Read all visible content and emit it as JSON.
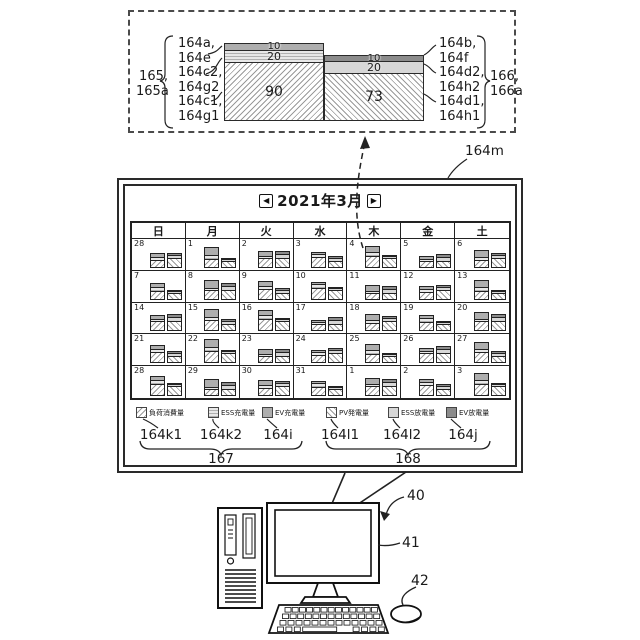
{
  "detail_inset": {
    "left_group_label": {
      "l1": "165,",
      "l2": "165a"
    },
    "right_group_label": {
      "l1": "166,",
      "l2": "166a"
    },
    "left_refs": [
      {
        "l1": "164a,",
        "l2": "164e"
      },
      {
        "l1": "164c2,",
        "l2": "164g2"
      },
      {
        "l1": "164c1,",
        "l2": "164g1"
      }
    ],
    "right_refs": [
      {
        "l1": "164b,",
        "l2": "164f"
      },
      {
        "l1": "164d2,",
        "l2": "164h2"
      },
      {
        "l1": "164d1,",
        "l2": "164h1"
      }
    ]
  },
  "chart_data": {
    "type": "bar",
    "stacked": true,
    "bars": [
      {
        "group_refs": "165, 165a",
        "segments": [
          {
            "value": 90,
            "refs": "164c1, 164g1",
            "legend": "負荷消費量",
            "pattern": "hatch-forward"
          },
          {
            "value": 20,
            "refs": "164c2, 164g2",
            "legend": "ESS充電量",
            "pattern": "horizontal-stripe"
          },
          {
            "value": 10,
            "refs": "164a, 164e",
            "legend": "EV充電量",
            "pattern": "gray-mid"
          }
        ]
      },
      {
        "group_refs": "166, 166a",
        "segments": [
          {
            "value": 73,
            "refs": "164d1, 164h1",
            "legend": "PV発電量",
            "pattern": "hatch-back"
          },
          {
            "value": 20,
            "refs": "164d2, 164h2",
            "legend": "ESS放電量",
            "pattern": "gray-light"
          },
          {
            "value": 10,
            "refs": "164b, 164f",
            "legend": "EV放電量",
            "pattern": "gray-dark"
          }
        ]
      }
    ]
  },
  "calendar": {
    "screen_ref": "164m",
    "title": "2021年3月",
    "prev_icon": "◀",
    "next_icon": "▶",
    "weekdays": [
      "日",
      "月",
      "火",
      "水",
      "木",
      "金",
      "土"
    ],
    "weeks": [
      [
        28,
        1,
        2,
        3,
        4,
        5,
        6
      ],
      [
        7,
        8,
        9,
        10,
        11,
        12,
        13
      ],
      [
        14,
        15,
        16,
        17,
        18,
        19,
        20
      ],
      [
        21,
        22,
        23,
        24,
        25,
        26,
        27
      ],
      [
        28,
        29,
        30,
        31,
        1,
        2,
        3
      ]
    ]
  },
  "legend": {
    "items": [
      {
        "label": "負荷消費量",
        "ref": "164k1",
        "pattern": "hatch-forward"
      },
      {
        "label": "ESS充電量",
        "ref": "164k2",
        "pattern": "horizontal-stripe"
      },
      {
        "label": "EV充電量",
        "ref": "164i",
        "pattern": "gray-mid"
      },
      {
        "label": "PV発電量",
        "ref": "164l1",
        "pattern": "hatch-back"
      },
      {
        "label": "ESS放電量",
        "ref": "164l2",
        "pattern": "gray-light"
      },
      {
        "label": "EV放電量",
        "ref": "164j",
        "pattern": "gray-dark"
      }
    ],
    "group1": "167",
    "group2": "168"
  },
  "hardware": {
    "computer_ref": "40",
    "monitor_ref": "41",
    "mouse_ref": "42"
  }
}
